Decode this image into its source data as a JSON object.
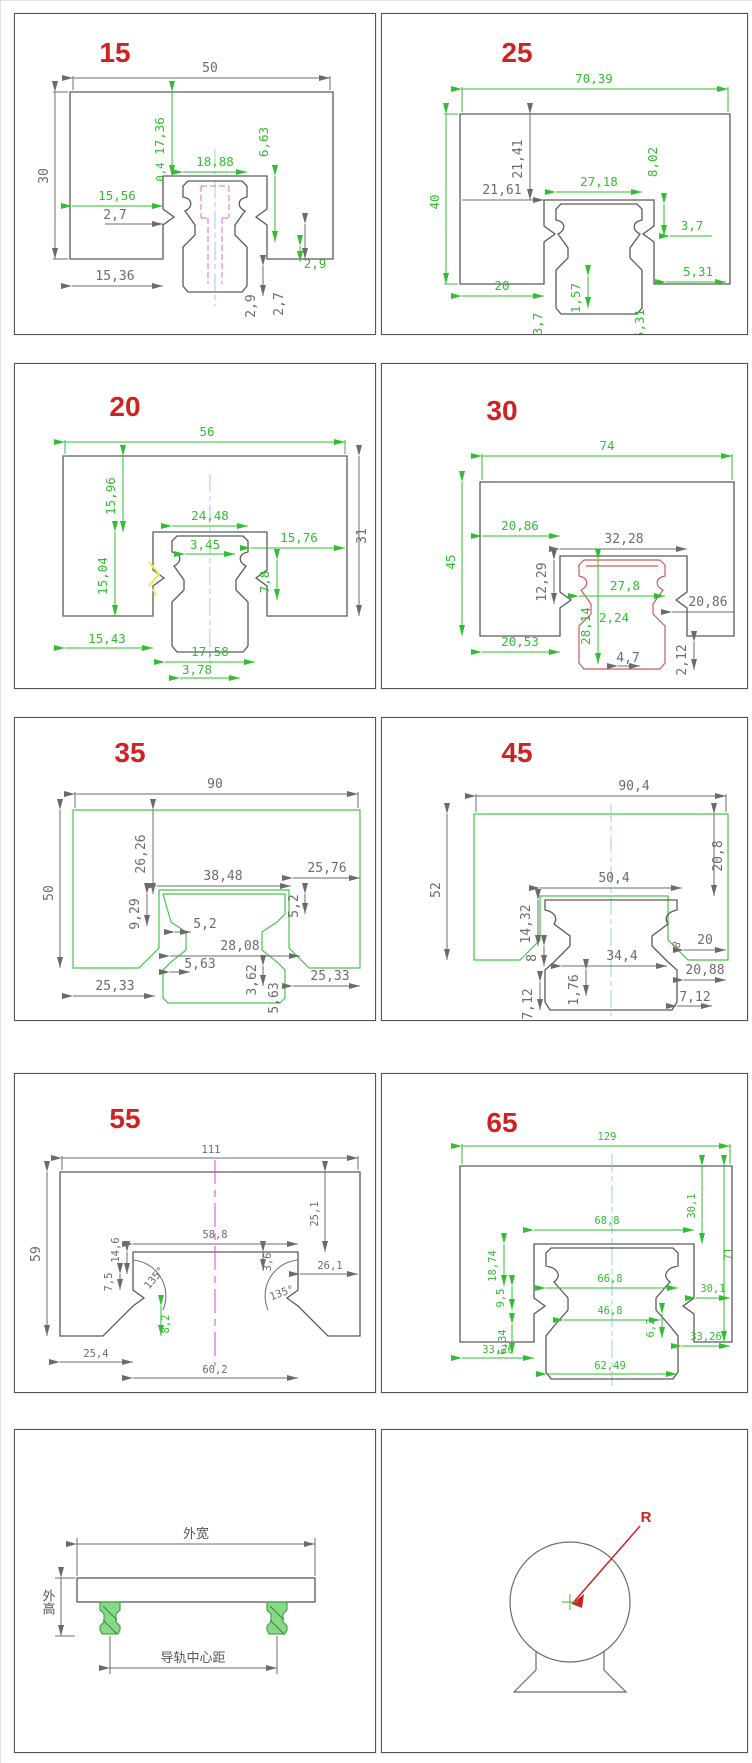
{
  "panels": [
    {
      "label": "15",
      "dims": [
        "50",
        "30",
        "17,36",
        "0,4",
        "18,88",
        "6,63",
        "15,56",
        "2,7",
        "15,36",
        "2,9",
        "2,7",
        "2,9"
      ]
    },
    {
      "label": "25",
      "dims": [
        "70,39",
        "40",
        "21,41",
        "21,61",
        "27,18",
        "8,02",
        "3,7",
        "20",
        "1,57",
        "5,31",
        "3,7",
        "5,31"
      ]
    },
    {
      "label": "20",
      "dims": [
        "56",
        "31",
        "15,96",
        "24,48",
        "3,45",
        "15,76",
        "15,04",
        "7,8",
        "15,43",
        "17,58",
        "3,78"
      ]
    },
    {
      "label": "30",
      "dims": [
        "74",
        "45",
        "20,86",
        "32,28",
        "12,29",
        "27,8",
        "28,14",
        "2,24",
        "20,86",
        "20,53",
        "4,7",
        "2,12"
      ]
    },
    {
      "label": "35",
      "dims": [
        "90",
        "50",
        "26,26",
        "38,48",
        "25,76",
        "9,29",
        "5,2",
        "5,2",
        "28,08",
        "5,63",
        "3,62",
        "5,63",
        "25,33",
        "25,33"
      ]
    },
    {
      "label": "45",
      "dims": [
        "90,4",
        "52",
        "20,8",
        "50,4",
        "14,32",
        "8",
        "8",
        "20",
        "34,4",
        "20,88",
        "1,76",
        "7,12",
        "7,12"
      ]
    },
    {
      "label": "55",
      "dims": [
        "111",
        "59",
        "25,1",
        "58,8",
        "14,6",
        "7,5",
        "135°",
        "3,6",
        "135°",
        "8,2",
        "26,1",
        "25,4",
        "60,2"
      ]
    },
    {
      "label": "65",
      "dims": [
        "129",
        "30,1",
        "71",
        "68,8",
        "18,74",
        "9,5",
        "66,8",
        "46,8",
        "30,1",
        "6,34",
        "6,2",
        "33,26",
        "33,26",
        "62,49"
      ]
    }
  ],
  "assembly": {
    "outer_width": "外宽",
    "outer_height": "外高",
    "rail_center_distance": "导轨中心距"
  },
  "radius": {
    "label": "R"
  },
  "colors": {
    "dim_green": "#2fbf2f",
    "dim_dark": "#6b6b6b",
    "panel_label_red": "#cf2222",
    "profile_red": "#cc5a5a",
    "magenta": "#de6ade",
    "cyan": "#8fcfcf"
  }
}
